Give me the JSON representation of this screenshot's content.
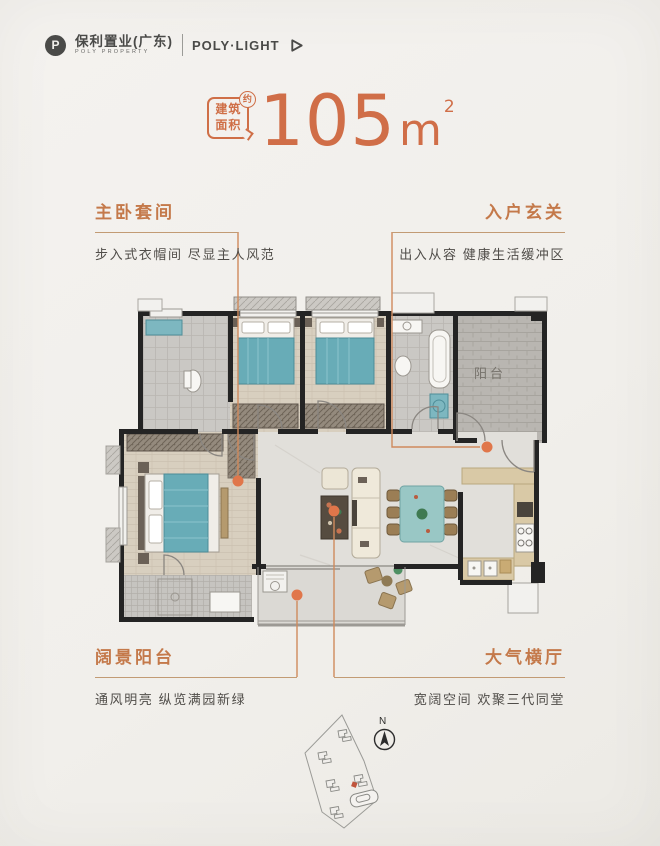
{
  "logo": {
    "monogram": "P",
    "cn": "保利置业(广东)",
    "en": "POLY PROPERTY",
    "product": "POLY·LIGHT"
  },
  "area": {
    "badge_line1": "建筑",
    "badge_line2": "面积",
    "approx": "约",
    "value": "105",
    "unit": "m",
    "power": "2"
  },
  "callouts": {
    "master_suite": {
      "title": "主卧套间",
      "desc": "步入式衣帽间 尽显主人风范"
    },
    "entry_foyer": {
      "title": "入户玄关",
      "desc": "出入从容 健康生活缓冲区"
    },
    "view_balcony": {
      "title": "阔景阳台",
      "desc": "通风明亮 纵览满园新绿"
    },
    "grand_hall": {
      "title": "大气横厅",
      "desc": "宽阔空间 欢聚三代同堂"
    }
  },
  "plan": {
    "balcony_label": "阳台"
  },
  "compass": {
    "north": "N"
  },
  "colors": {
    "accent_orange": "#d06e48",
    "title_orange": "#c4794a",
    "connector_line": "#cf8a5c",
    "dot_orange": "#e0764a",
    "wall_black": "#242424",
    "bed_teal": "#68acb7",
    "text_gray": "#504d49"
  }
}
